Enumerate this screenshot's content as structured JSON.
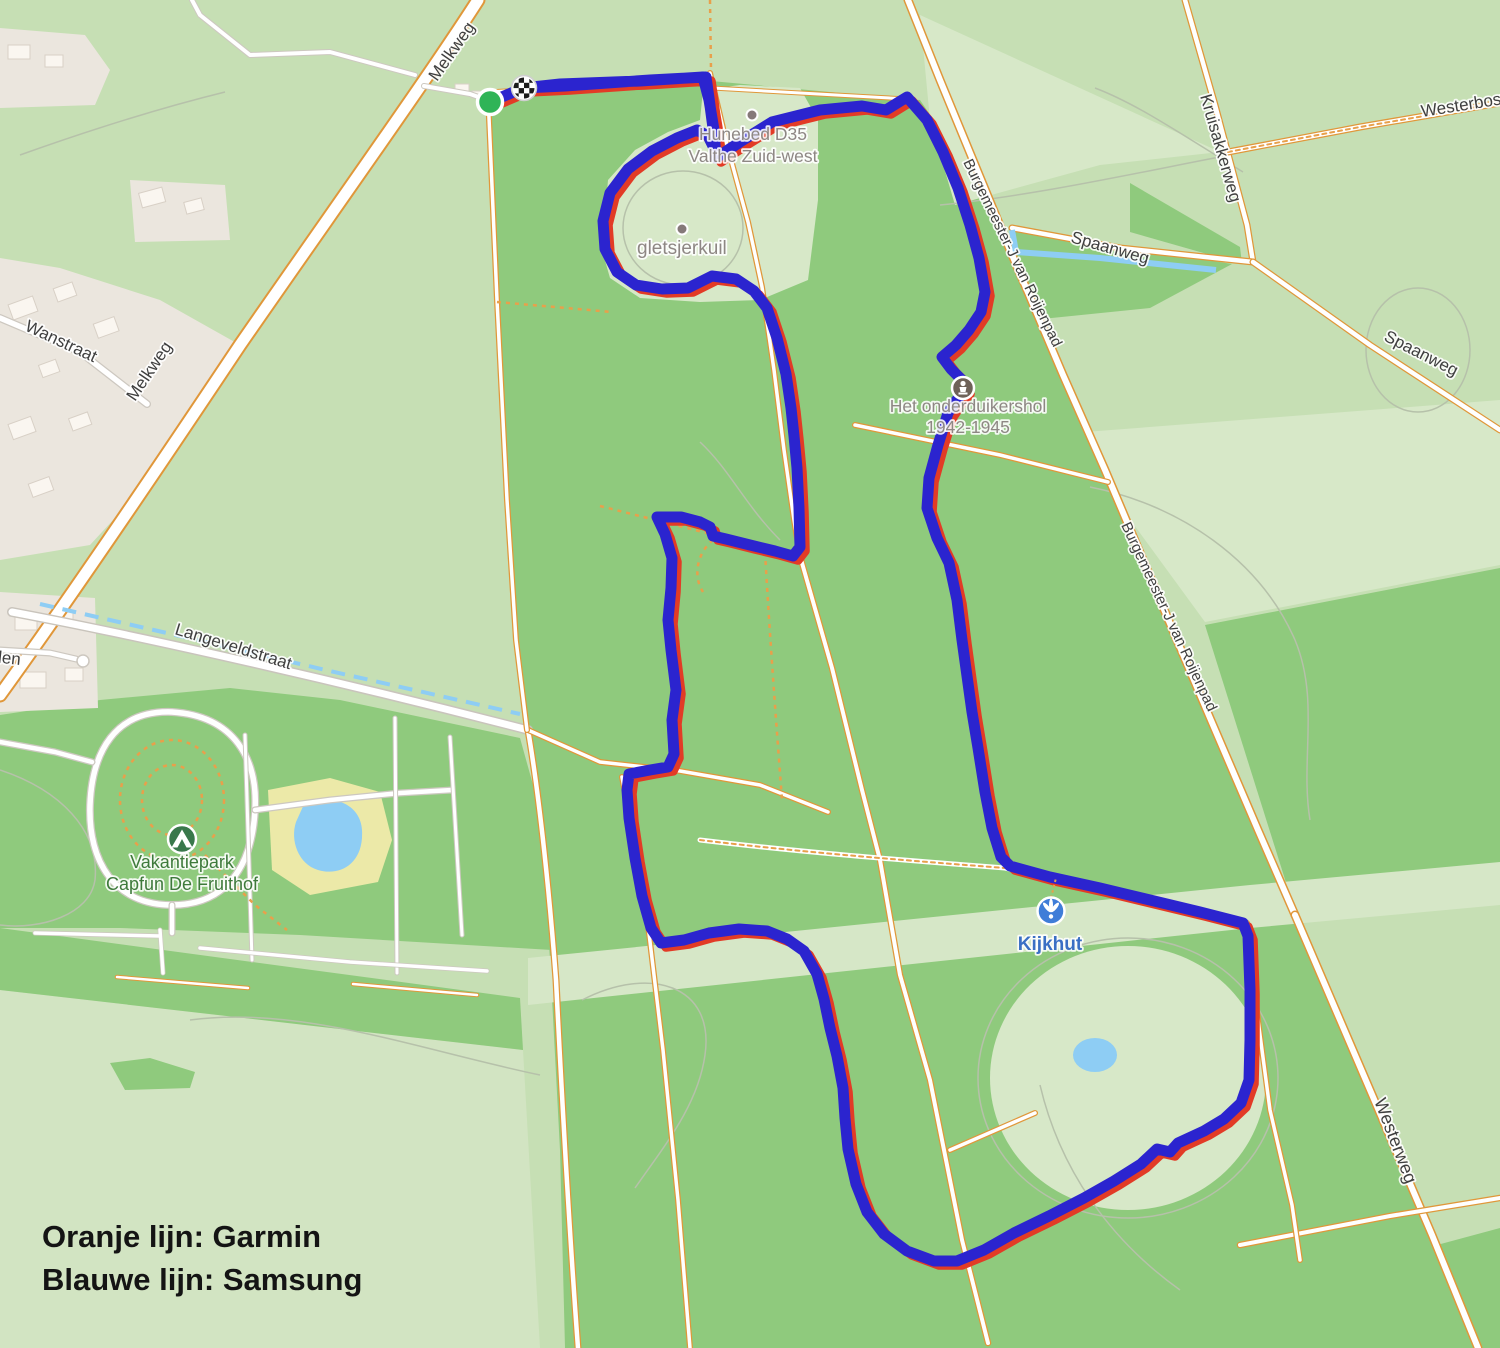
{
  "map": {
    "labels": {
      "melkweg": "Melkweg",
      "wanstraat": "Wanstraat",
      "langeveldstraat": "Langeveldstraat",
      "den_partial": "den",
      "kruisakkerweg": "Kruisakkerweg",
      "westerbosweg_partial": "Westerboswe",
      "spaanweg": "Spaanweg",
      "burgemeester": "Burgemeester-J van Roijenpad",
      "westerweg": "Westerweg",
      "gletsjerkuil": "gletsjerkuil",
      "hunebed_line1": "Hunebed D35",
      "hunebed_line2": "Valthe Zuid-west",
      "onderduikershol_line1": "Het onderduikershol",
      "onderduikershol_line2": "1942-1945",
      "kijkhut": "Kijkhut",
      "vakantiepark_line1": "Vakantiepark",
      "vakantiepark_line2": "Capfun De Fruithof"
    },
    "colors": {
      "base_green": "#c6dfb4",
      "forest_green": "#8fca7d",
      "clearing_green": "#d7e8c8",
      "residential_beige": "#ebe6de",
      "water_blue": "#8ecdf4",
      "road_casing_orange": "#e0973a",
      "kijkhut_label_blue": "#3a6fc4",
      "vakantiepark_label_green": "#3e7a3b",
      "start_marker_green": "#2fb457"
    }
  },
  "route": {
    "garmin": {
      "label": "Garmin",
      "color": "#e23b26"
    },
    "samsung": {
      "label": "Samsung",
      "color": "#2b24cf"
    }
  },
  "legend": {
    "line1": "Oranje lijn: Garmin",
    "line2": "Blauwe lijn: Samsung"
  }
}
